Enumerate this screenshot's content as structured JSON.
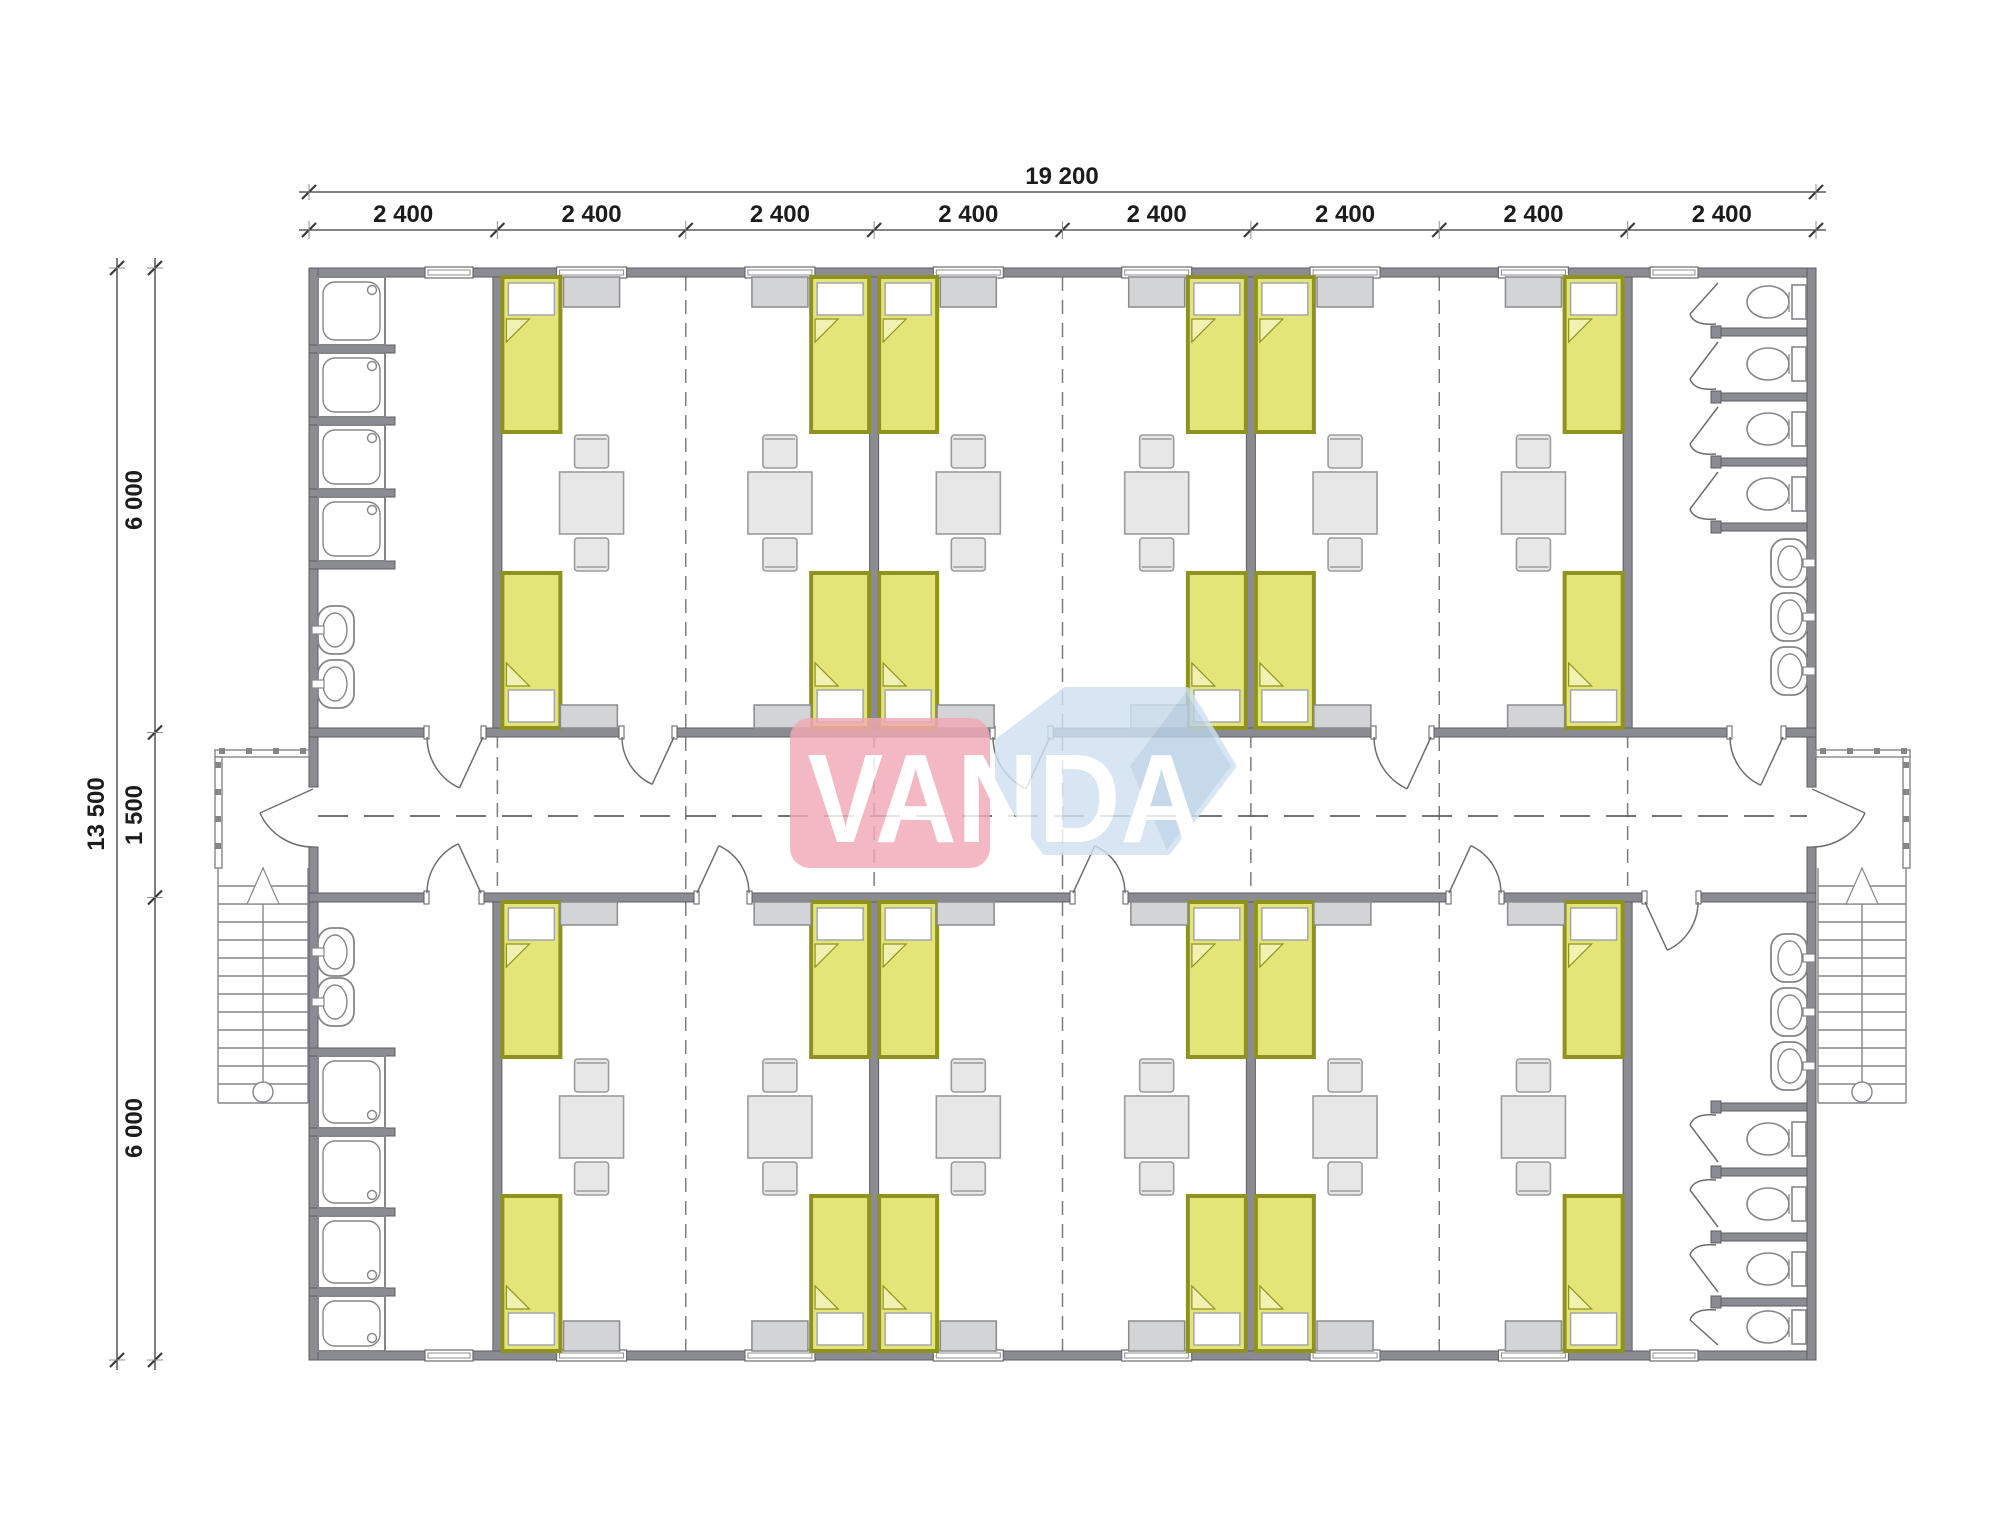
{
  "logo": {
    "text": "VANDA",
    "pink": "#f2a9b5",
    "blue_light": "#cfe1f0",
    "blue_dark": "#b9d1e7",
    "text_color": "#ffffff"
  },
  "dimensions": {
    "top_total": "19 200",
    "top_modules": [
      "2 400",
      "2 400",
      "2 400",
      "2 400",
      "2 400",
      "2 400",
      "2 400",
      "2 400"
    ],
    "left_total": "13 500",
    "left_segments": [
      "6 000",
      "1 500",
      "6 000"
    ]
  },
  "colors": {
    "wall_fill": "#8b8c93",
    "wall_edge": "#5c5d61",
    "fixture_line": "#85868a",
    "furniture_fill": "#e7e7e7",
    "furniture_edge": "#9a9b9e",
    "wardrobe_fill": "#d3d4d6",
    "wardrobe_edge": "#8a8b8e",
    "bed_fill": "#e4e579",
    "bed_frame": "#8f921e",
    "bed_fold": "#f1f2b2",
    "pillow_fill": "#ffffff",
    "pillow_edge": "#a5a6a8",
    "dash_center": "#606165",
    "dash_joint": "#7b7c80",
    "dim_line": "#3a3a3c",
    "dim_text": "#1c1c1e"
  }
}
